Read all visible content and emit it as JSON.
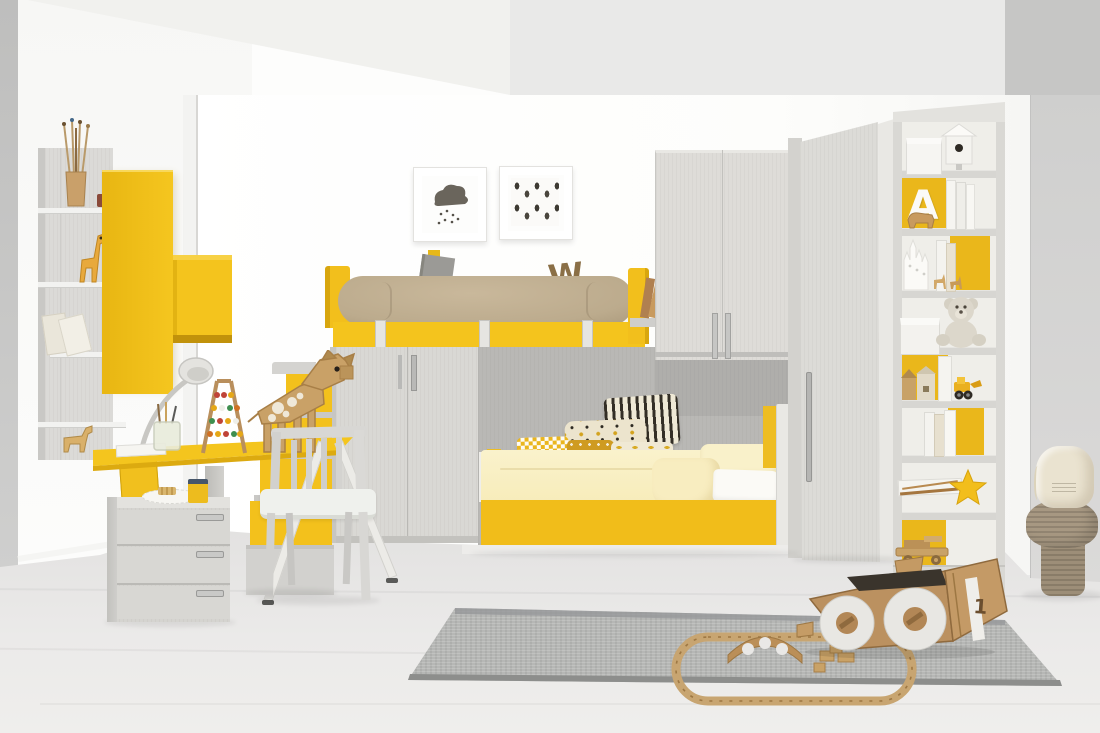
{
  "scene": {
    "type": "interior photograph",
    "description": "Children's bedroom with yellow and light-grey modular furniture: loft bunk bed with stairs, lower bed with patterned pillows, desk with cardboard giraffe toy, wardrobes, tall bookshelf, cardboard race car and wooden train track on a grey rug, jute mushroom pouf",
    "palette": {
      "accent_yellow": "#f2c01d",
      "accent_yellow_dark": "#d8a60e",
      "bolster_beige": "#c0af92",
      "furniture_grey": "#d9d8d4",
      "panel_grey": "#b9b8b5",
      "wall_white": "#fbfbfa",
      "wall_grey_right": "#d6d6d5",
      "floor_grey": "#e8e7e6",
      "rug_grey": "#b4b5b3",
      "cardboard_tan": "#bb9160",
      "bedding_pale_yellow": "#f9efc4",
      "pillow_black": "#332e26",
      "mustard": "#cf9b21"
    }
  },
  "text": {
    "bolster_letter": "W",
    "bookshelf_letter": "A",
    "car_number": "1"
  },
  "objects": {
    "left_wall": [
      "wall shelf unit",
      "brush cup",
      "toy giraffe figurine",
      "picture frames",
      "leaning books",
      "toy horse",
      "yellow magazine"
    ],
    "cabinets": [
      "tall yellow wall cabinet",
      "suspended yellow box shelf"
    ],
    "desk_area": [
      "yellow desk",
      "desk lamp",
      "abacus",
      "cardboard giraffe",
      "pencil jar",
      "drawer unit",
      "doily plate",
      "yellow cup",
      "white chair"
    ],
    "bunk": [
      "loft bed with beige bolster",
      "yellow frame band",
      "hanging straps",
      "grey book",
      "wooden letter",
      "storage stairs with yellow drawers",
      "two-door cabinet"
    ],
    "lower_bed": [
      "striped pillow",
      "dotted pillow",
      "houndstooth pillows",
      "banana print pillow",
      "pale yellow duvet",
      "yellow storage base"
    ],
    "wardrobes": [
      "bridge wardrobe with two doors",
      "angled corner wardrobe"
    ],
    "bookshelf_items": [
      "white box",
      "birdhouse",
      "letter A",
      "bison figurine",
      "books",
      "castle silhouette",
      "deer figurines",
      "teddy bear",
      "house figurines",
      "toy excavator",
      "star wand",
      "wooden toy car"
    ],
    "floor_items": [
      "grey rug",
      "cardboard race car",
      "wooden train track",
      "wooden bridge",
      "wooden blocks",
      "jute mushroom pouf",
      "canvas drawstring bag"
    ]
  }
}
